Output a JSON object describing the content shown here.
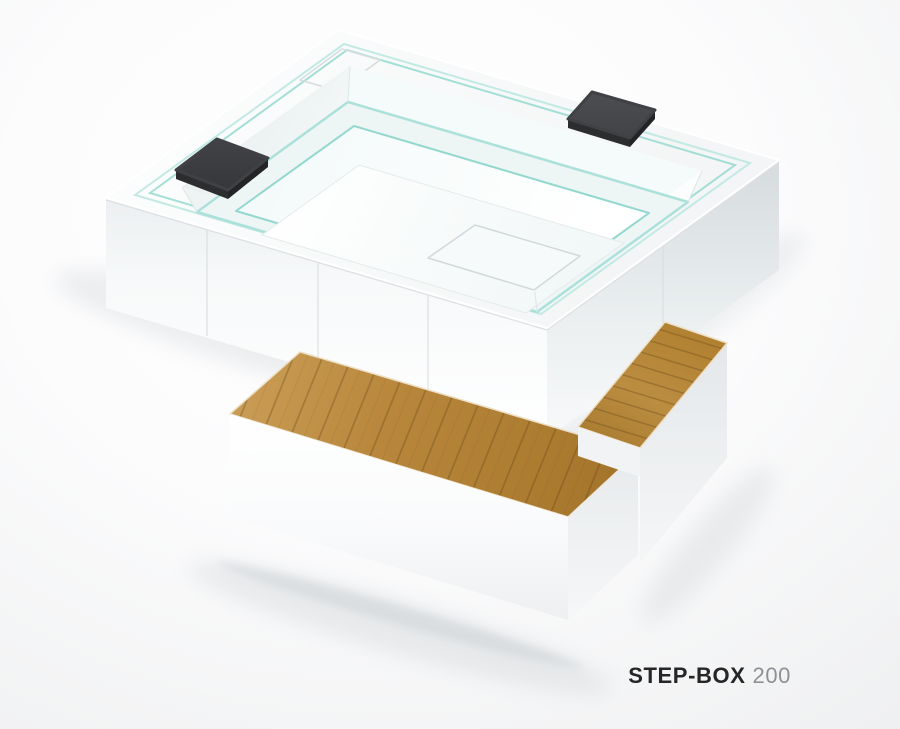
{
  "product": {
    "series": "STEP-BOX",
    "model": "200"
  },
  "caption": {
    "text": "STEP-BOX 200"
  },
  "scene": {
    "type": "product-render",
    "subject": "square white spa tub with glass benches, two charcoal headrests and a two-level teak step unit",
    "background": "white studio sweep"
  },
  "colors": {
    "background_edge": "#f1f2f3",
    "tub_white": "#fafbfc",
    "cabinet_shade": "#d9dee1",
    "glass_aqua": "#9adcd3",
    "glass_aqua_light": "#c2e9e3",
    "headrest_charcoal": "#3a3b3e",
    "wood_light": "#c99c55",
    "wood_dark": "#a07128",
    "ground_shadow": "#aeb6bb",
    "caption_name": "#262626",
    "caption_model": "#8e9093"
  }
}
